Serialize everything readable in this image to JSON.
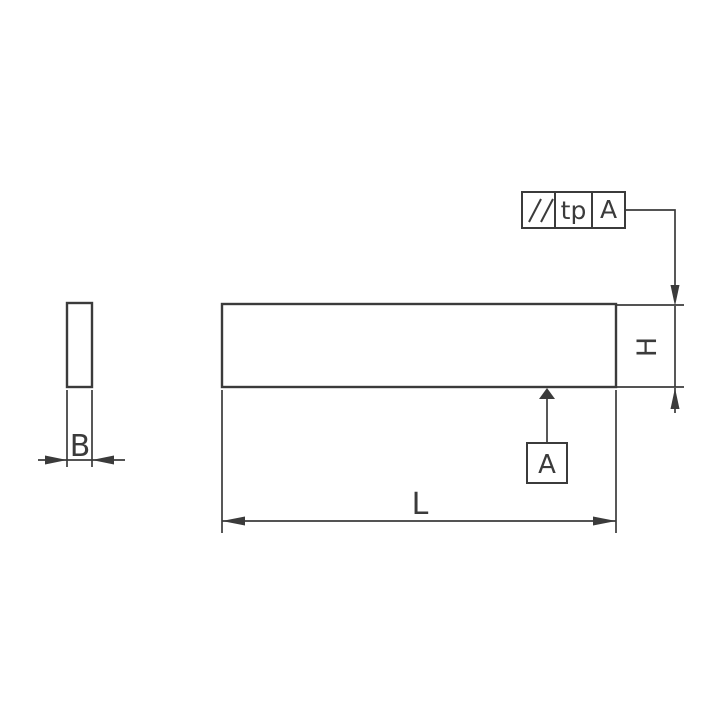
{
  "colors": {
    "background": "#ffffff",
    "line": "#3b3b3b"
  },
  "dimensions": {
    "length_label": "L",
    "width_label": "B",
    "height_label": "H"
  },
  "feature_control_frame": {
    "symbol_icon": "parallelism-icon",
    "symbol_glyph": "//",
    "tolerance": "tp",
    "datum_ref": "A"
  },
  "datum": {
    "label": "A"
  }
}
